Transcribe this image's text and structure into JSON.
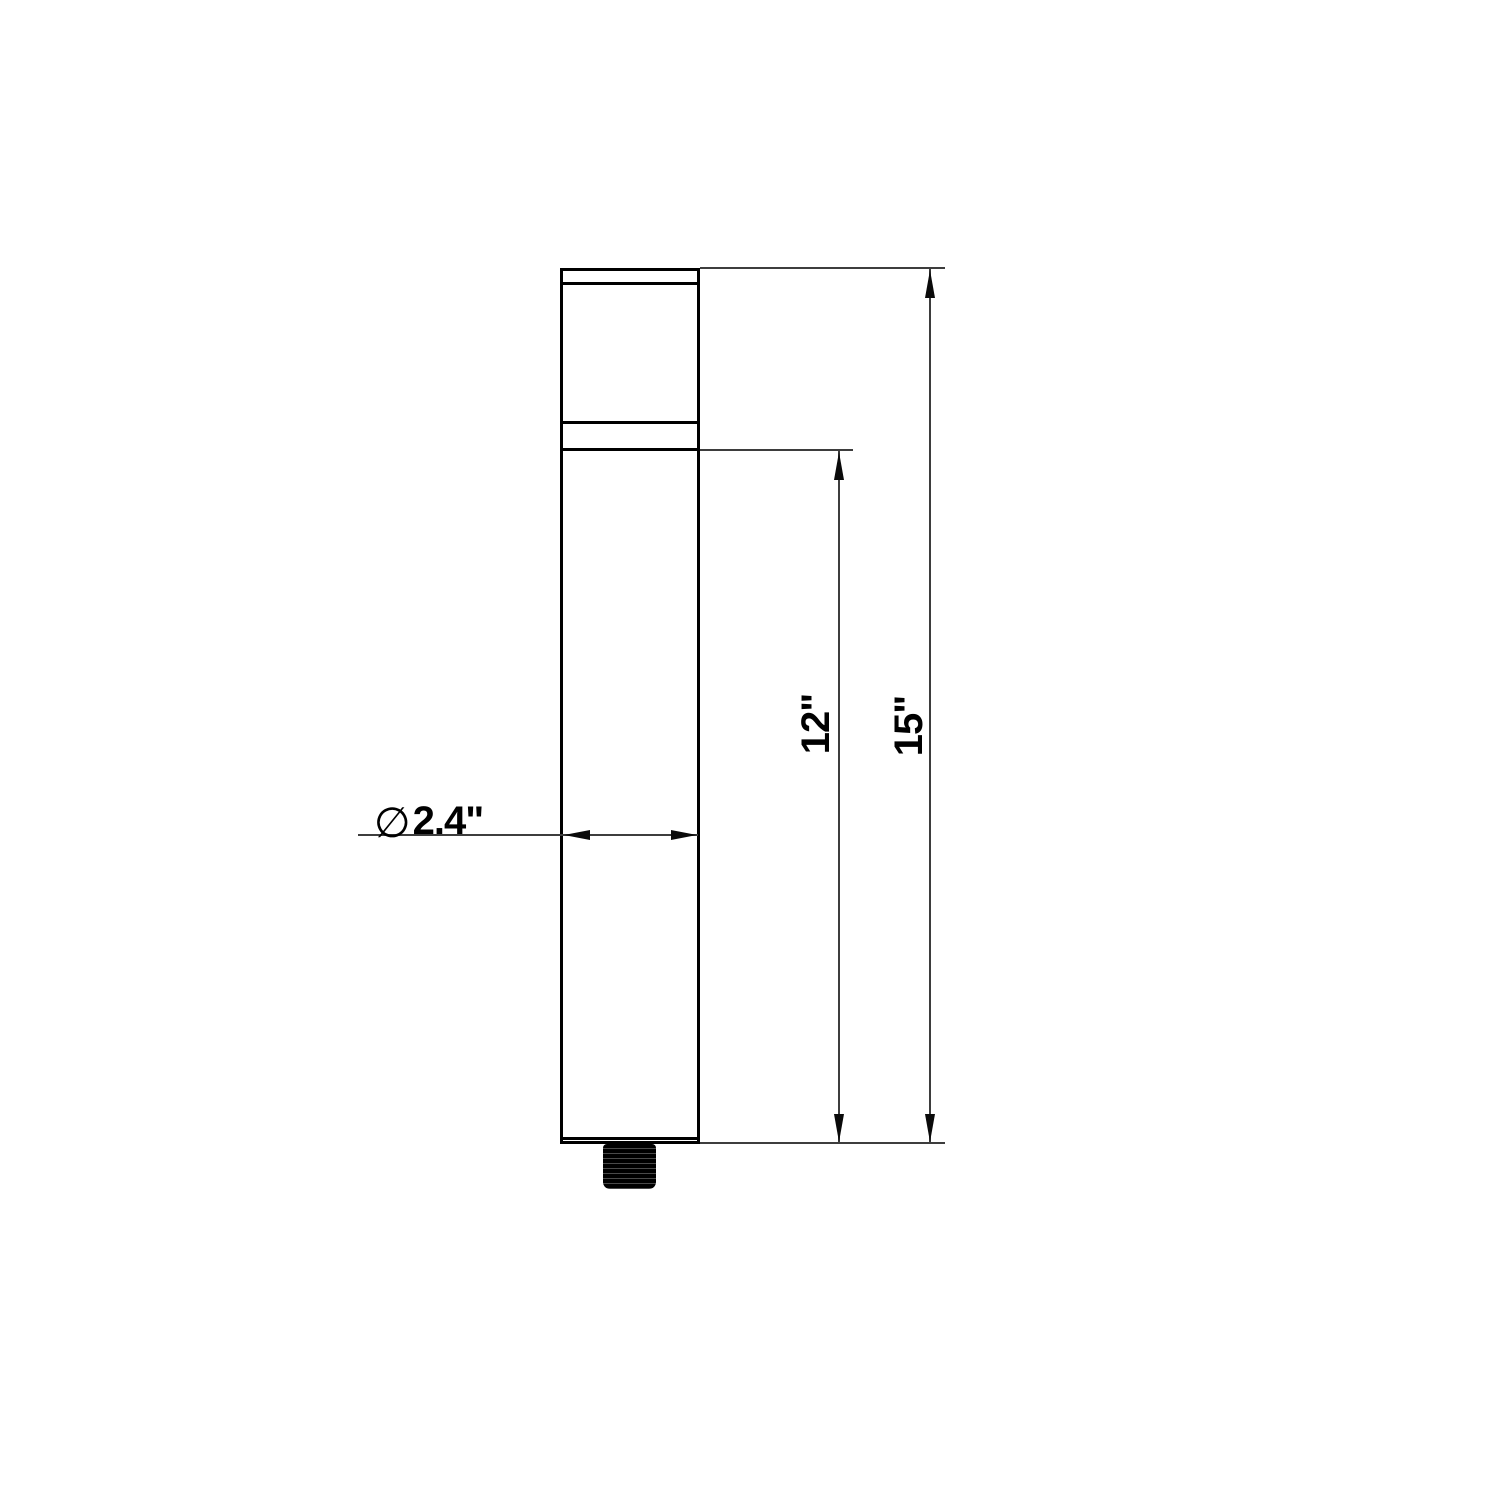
{
  "drawing": {
    "type": "technical-dimension-drawing",
    "colors": {
      "background": "#ffffff",
      "outline": "#000000",
      "thin_line": "#3d3d3d"
    },
    "dimensions": {
      "overall_height_label": "15\"",
      "body_height_label": "12\"",
      "diameter_symbol": "∅",
      "diameter_value_label": "2.4\""
    }
  }
}
